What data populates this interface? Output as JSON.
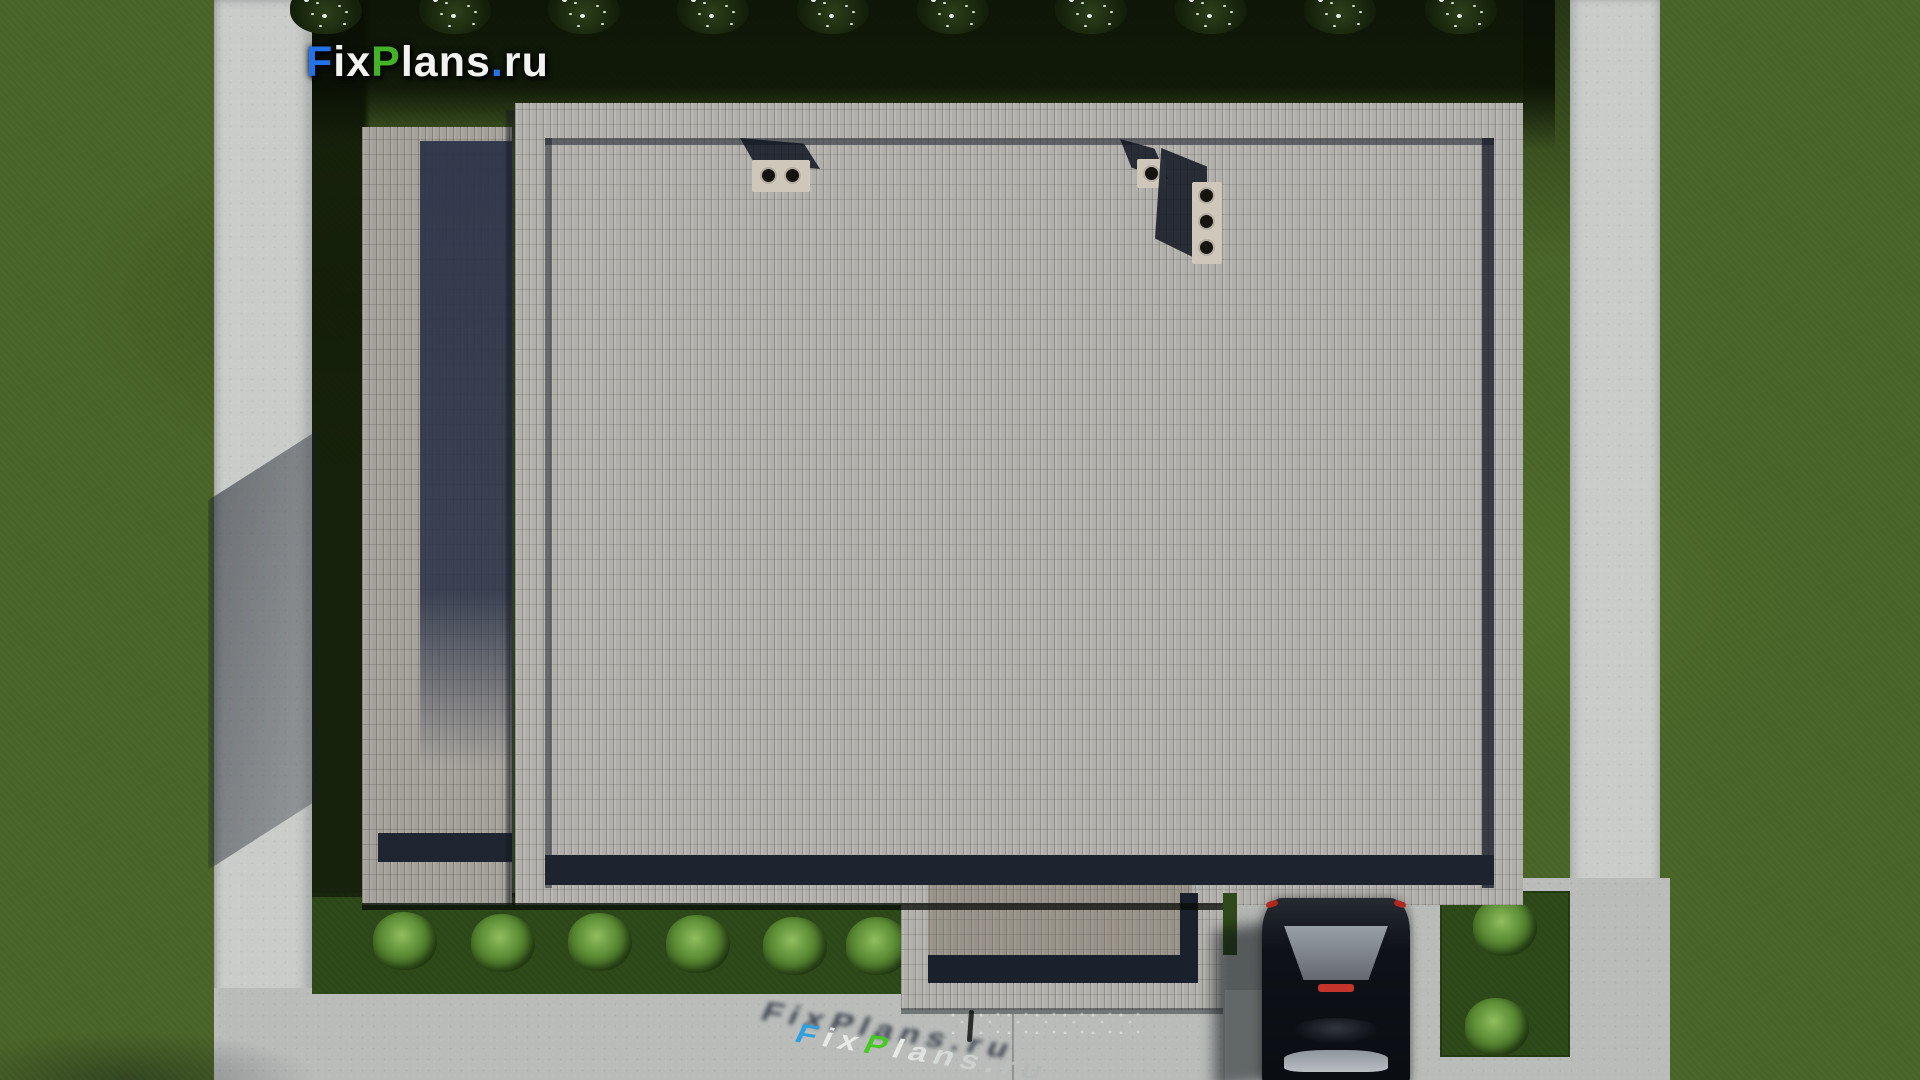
{
  "scene": {
    "description": "Aerial top-down 3D architectural render of a flat-roof house plot: paver-textured roof, lawn, concrete walkways, entrance porch, driveway with parked dark car, ornamental bushes",
    "logo": {
      "text": "FixPlans.ru",
      "letters": [
        {
          "ch": "F",
          "color": "#2472e8"
        },
        {
          "ch": "i",
          "color": "#f2f3f1"
        },
        {
          "ch": "x",
          "color": "#f2f3f1"
        },
        {
          "ch": "P",
          "color": "#43b227"
        },
        {
          "ch": "l",
          "color": "#f2f3f1"
        },
        {
          "ch": "a",
          "color": "#f2f3f1"
        },
        {
          "ch": "n",
          "color": "#f2f3f1"
        },
        {
          "ch": "s",
          "color": "#f2f3f1"
        },
        {
          "ch": ".",
          "color": "#2472e8"
        },
        {
          "ch": "r",
          "color": "#f2f3f1"
        },
        {
          "ch": "u",
          "color": "#f2f3f1"
        }
      ]
    },
    "ground_watermark": {
      "text": "FixPlans.ru",
      "letters": [
        {
          "ch": "F",
          "color": "#2f9fe0"
        },
        {
          "ch": "i",
          "color": "#e8eae8"
        },
        {
          "ch": "x",
          "color": "#e8eae8"
        },
        {
          "ch": "P",
          "color": "#46c922"
        },
        {
          "ch": "l",
          "color": "#e8eae8"
        },
        {
          "ch": "a",
          "color": "#dfe2e0"
        },
        {
          "ch": "n",
          "color": "#d5d9d7"
        },
        {
          "ch": "s",
          "color": "#cdd1cf"
        },
        {
          "ch": ".",
          "color": "#c4c8c6"
        },
        {
          "ch": "r",
          "color": "#bcc0be"
        },
        {
          "ch": "u",
          "color": "#b4b8b6"
        }
      ]
    },
    "colors": {
      "grass_sunlit": "#4b6629",
      "grass_shadowed": "#15220b",
      "grass_strip": "#2e4a19",
      "concrete_path": "#c9ccc9",
      "concrete_apron": "#b9bcb9",
      "driveway": "#b2b5b2",
      "roof_pavers_main": "#b6b4b0",
      "roof_pavers_wing": "#a9a6a0",
      "parapet_shadow": "#1d2430",
      "wing_glass": "#2c3448",
      "chimney_box": "#cec7ba",
      "car_body": "#0e1218",
      "car_tail_light": "#c5342a"
    },
    "objects": {
      "main_roof": {
        "label": "main flat roof with running-bond paver texture and recessed parapet shadow frame"
      },
      "left_wing_roof": {
        "label": "lower left wing roof with dark glazed strip"
      },
      "entrance_porch_roof": {
        "label": "lower entrance porch roof with recessed dark L-shaped edge"
      },
      "chimneys": [
        {
          "label": "twin round vent chimney",
          "vents": 2
        },
        {
          "label": "single round vent chimney",
          "vents": 1
        },
        {
          "label": "triple round vent chimney",
          "vents": 3
        }
      ],
      "car": {
        "label": "dark car parked on driveway, viewed from above, rear facing up"
      },
      "top_bushes": {
        "label": "row of white-flowering bushes along shaded top lawn",
        "items": [
          {
            "x": 326,
            "y": 0
          },
          {
            "x": 455,
            "y": 0
          },
          {
            "x": 584,
            "y": 0
          },
          {
            "x": 713,
            "y": 0
          },
          {
            "x": 833,
            "y": 0
          },
          {
            "x": 953,
            "y": 0
          },
          {
            "x": 1091,
            "y": 0
          },
          {
            "x": 1211,
            "y": 0
          },
          {
            "x": 1340,
            "y": 0
          },
          {
            "x": 1461,
            "y": 0
          }
        ]
      },
      "bottom_bushes": {
        "label": "row of round green bushes below roof edge, shadows cast up-left",
        "items": [
          {
            "x": 405,
            "y": 912
          },
          {
            "x": 503,
            "y": 914
          },
          {
            "x": 600,
            "y": 913
          },
          {
            "x": 698,
            "y": 915
          },
          {
            "x": 795,
            "y": 917
          },
          {
            "x": 878,
            "y": 917
          }
        ]
      },
      "corner_bushes": {
        "label": "two bushes on small grass patch right of driveway",
        "items": [
          {
            "x": 1505,
            "y": 898
          },
          {
            "x": 1497,
            "y": 998
          }
        ]
      }
    }
  }
}
